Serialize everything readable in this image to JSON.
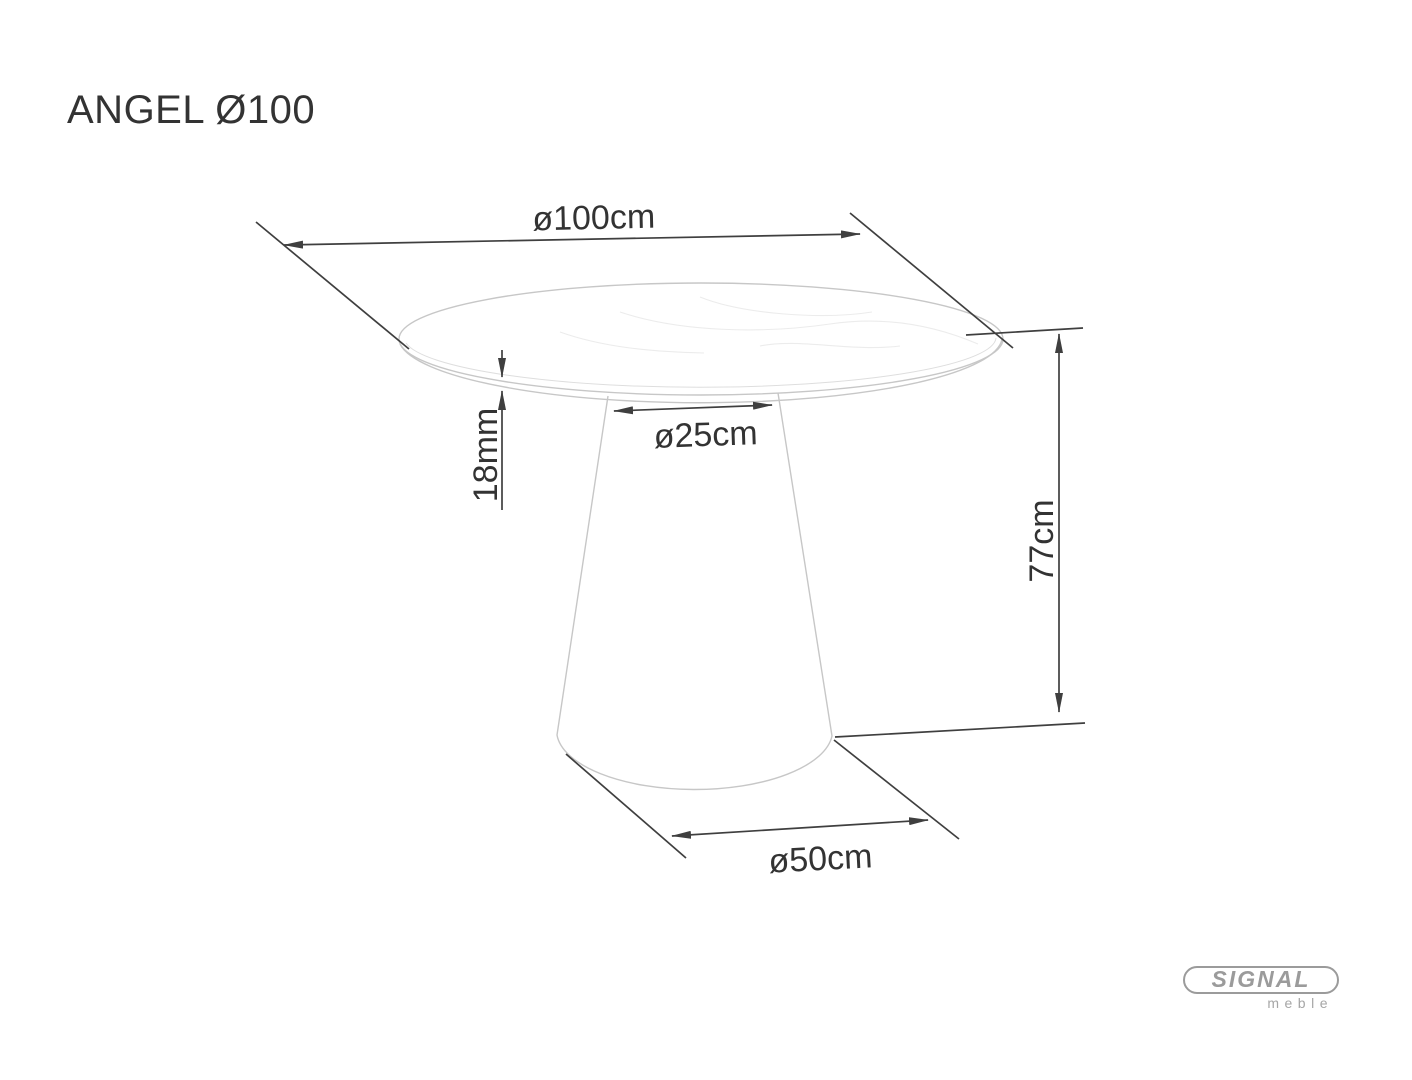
{
  "header": {
    "title": "ANGEL Ø100"
  },
  "dimensions": {
    "top_diameter": "ø100cm",
    "top_thickness": "18mm",
    "column_diameter": "ø25cm",
    "height": "77cm",
    "base_diameter": "ø50cm"
  },
  "logo": {
    "brand": "SIGNAL",
    "subtitle": "meble"
  },
  "colors": {
    "dimension_line": "#3f3f3f",
    "drawing_outline": "#c7c7c7",
    "label_text": "#333333",
    "logo_gray": "#9b9b9b",
    "background": "#ffffff"
  }
}
